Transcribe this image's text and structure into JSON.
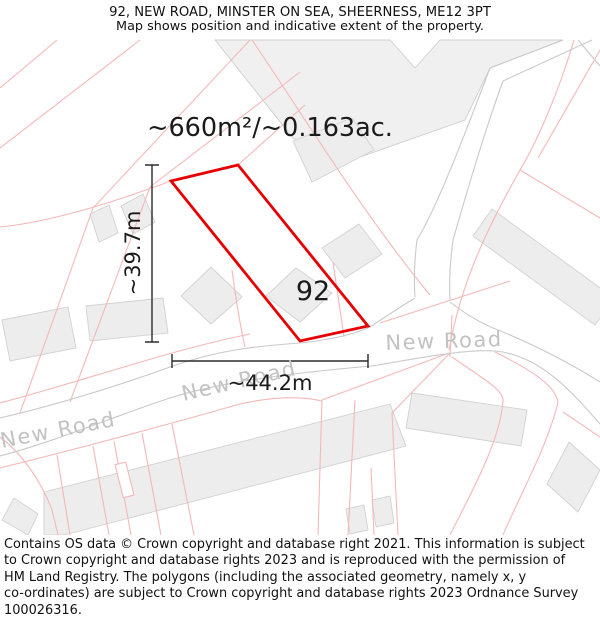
{
  "header": {
    "title": "92, NEW ROAD, MINSTER ON SEA, SHEERNESS, ME12 3PT",
    "subtitle": "Map shows position and indicative extent of the property."
  },
  "map": {
    "area_label": "~660m²/~0.163ac.",
    "width_label": "~44.2m",
    "height_label": "~39.7m",
    "plot_number": "92",
    "road_name": "New Road",
    "colors": {
      "property_boundary": "#e60000",
      "parcel_line": "#f4b8b8",
      "road_edge": "#c9c9c9",
      "building_fill": "#ededed",
      "road_label_text": "#c2c2c2",
      "dimension_line": "#2b2b2b"
    }
  },
  "footer": {
    "lines": [
      "Contains OS data © Crown copyright and database right 2021. This information is subject",
      "to Crown copyright and database rights 2023 and is reproduced with the permission of",
      "HM Land Registry. The polygons (including the associated geometry, namely x, y",
      "co-ordinates) are subject to Crown copyright and database rights 2023 Ordnance Survey",
      "100026316."
    ]
  }
}
